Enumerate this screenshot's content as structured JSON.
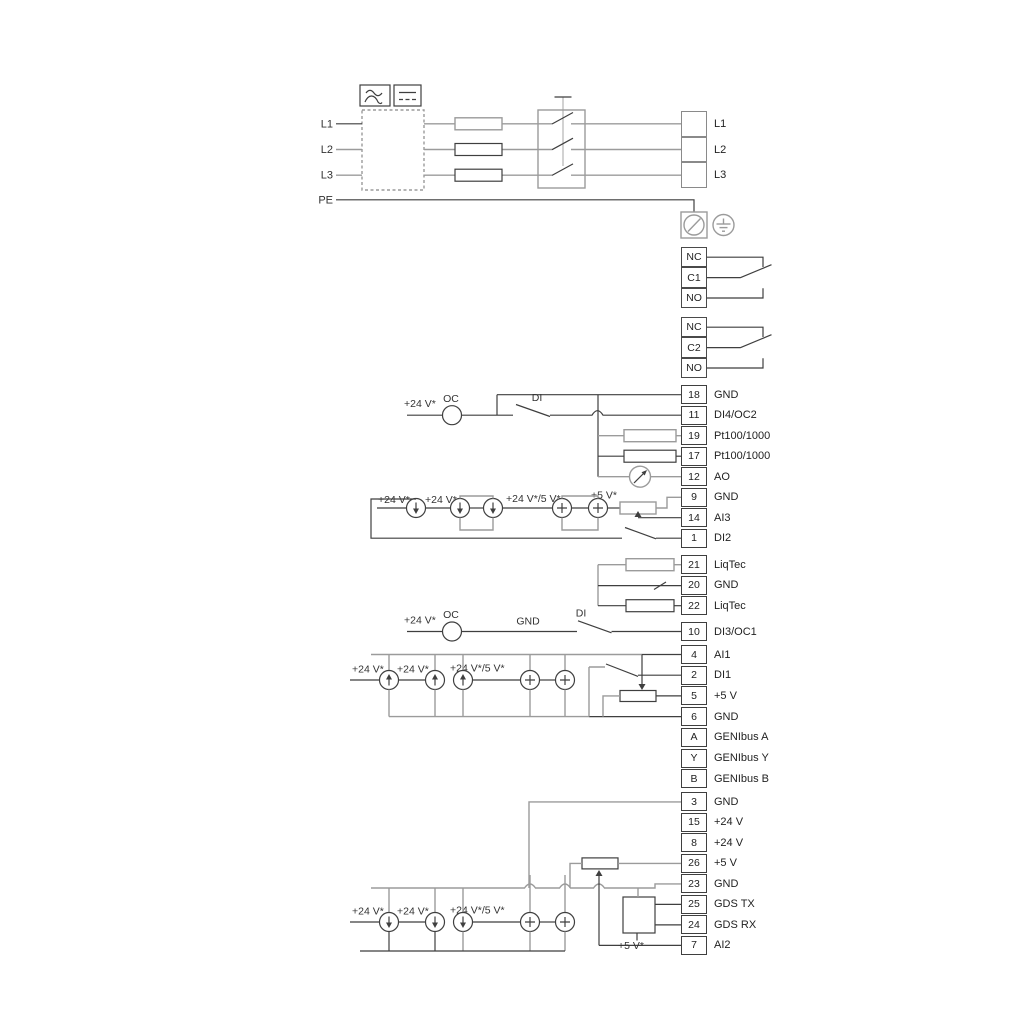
{
  "diagram_title": "Pump drive wiring diagram",
  "labels": {
    "in_l1": "L1",
    "in_l2": "L2",
    "in_l3": "L3",
    "pe": "PE",
    "di4_supply": "+24 V*",
    "di4_oc": "OC",
    "di4_di": "DI",
    "ai3_s1": "+24 V*",
    "ai3_s2": "+24 V*",
    "ai3_s3": "+24 V*/5 V*",
    "ai3_s4": "+5 V*",
    "di3_supply": "+24 V*",
    "di3_oc": "OC",
    "di3_gnd": "GND",
    "di3_di": "DI",
    "ai1_s1": "+24 V*",
    "ai1_s2": "+24 V*",
    "ai1_s3": "+24 V*/5 V*",
    "ai2_s1": "+24 V*",
    "ai2_s2": "+24 V*",
    "ai2_s3": "+24 V*/5 V*",
    "ai2_s4": "+5 V*"
  },
  "power_out": {
    "cells": [
      {
        "num": "",
        "label": "L1"
      },
      {
        "num": "",
        "label": "L2"
      },
      {
        "num": "",
        "label": "L3"
      }
    ]
  },
  "relays": [
    {
      "cells": [
        "NC",
        "C1",
        "NO"
      ]
    },
    {
      "cells": [
        "NC",
        "C2",
        "NO"
      ]
    }
  ],
  "terminal_groups": [
    {
      "name": "io-top",
      "terminals": [
        {
          "num": "18",
          "label": "GND"
        },
        {
          "num": "11",
          "label": "DI4/OC2"
        },
        {
          "num": "19",
          "label": "Pt100/1000"
        },
        {
          "num": "17",
          "label": "Pt100/1000"
        },
        {
          "num": "12",
          "label": "AO"
        },
        {
          "num": "9",
          "label": "GND"
        },
        {
          "num": "14",
          "label": "AI3"
        },
        {
          "num": "1",
          "label": "DI2"
        }
      ]
    },
    {
      "name": "liqtec",
      "terminals": [
        {
          "num": "21",
          "label": "LiqTec"
        },
        {
          "num": "20",
          "label": "GND"
        },
        {
          "num": "22",
          "label": "LiqTec"
        }
      ]
    },
    {
      "name": "di3",
      "terminals": [
        {
          "num": "10",
          "label": "DI3/OC1"
        }
      ]
    },
    {
      "name": "ai1-genibus",
      "terminals": [
        {
          "num": "4",
          "label": "AI1"
        },
        {
          "num": "2",
          "label": "DI1"
        },
        {
          "num": "5",
          "label": "+5 V"
        },
        {
          "num": "6",
          "label": "GND"
        },
        {
          "num": "A",
          "label": "GENIbus A"
        },
        {
          "num": "Y",
          "label": "GENIbus Y"
        },
        {
          "num": "B",
          "label": "GENIbus B"
        }
      ]
    },
    {
      "name": "bottom",
      "terminals": [
        {
          "num": "3",
          "label": "GND"
        },
        {
          "num": "15",
          "label": "+24 V"
        },
        {
          "num": "8",
          "label": "+24 V"
        },
        {
          "num": "26",
          "label": "+5 V"
        },
        {
          "num": "23",
          "label": "GND"
        },
        {
          "num": "25",
          "label": "GDS TX"
        },
        {
          "num": "24",
          "label": "GDS RX"
        },
        {
          "num": "7",
          "label": "AI2"
        }
      ]
    }
  ],
  "colors": {
    "wire_gray": "#9b9b9b",
    "wire_dark": "#3f3f3f",
    "text": "#333333"
  }
}
